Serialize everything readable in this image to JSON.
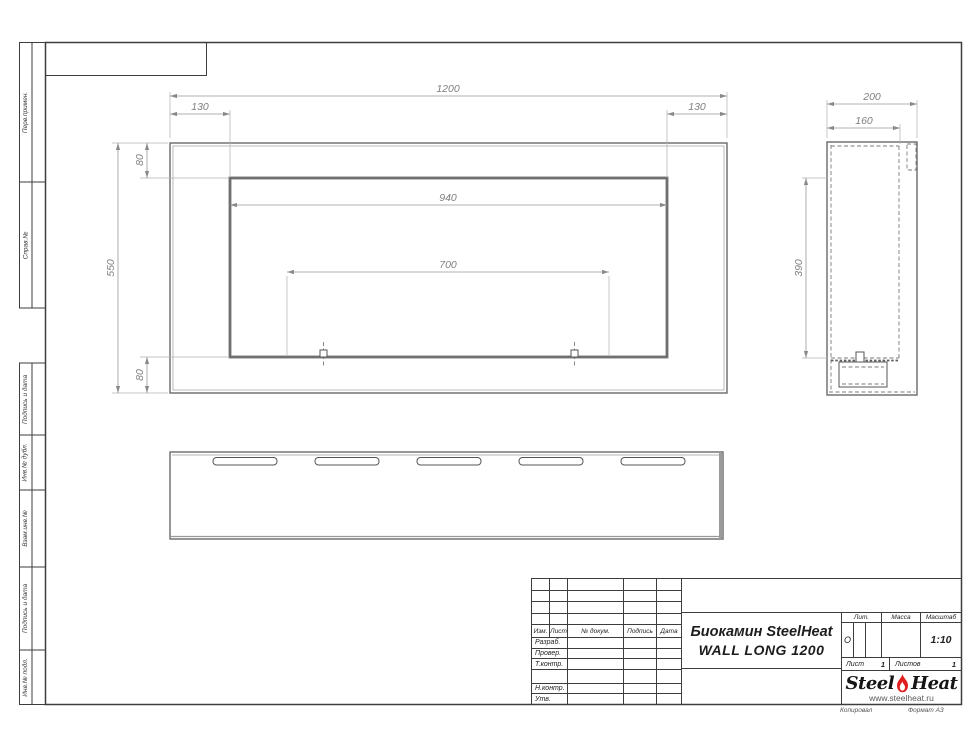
{
  "page": {
    "bg": "#ffffff",
    "frame_color": "#3d3d3d",
    "object_line_color": "#6a6a6a",
    "dim_color": "#7f7f7f",
    "flame_color": "#e01f1f"
  },
  "side_strip": {
    "labels": [
      "Перв.примен.",
      "Справ.№",
      "Подпись и дата",
      "Инв.№ дубл.",
      "Взам.инв.№",
      "Подпись и дата",
      "Инв.№ подл."
    ]
  },
  "front_view": {
    "dim_width": "1200",
    "dim_left_inset": "130",
    "dim_right_inset": "130",
    "dim_opening_width": "940",
    "dim_burner_span": "700",
    "dim_height": "550",
    "dim_top_inset": "80",
    "dim_bottom_inset": "80"
  },
  "side_view": {
    "dim_depth": "200",
    "dim_inner_depth": "160",
    "dim_opening_height": "390"
  },
  "title_block": {
    "header_cols": [
      "Изм.",
      "Лист",
      "№ докум.",
      "Подпись",
      "Дата"
    ],
    "row_labels": [
      "Разраб.",
      "Провер.",
      "Т.контр.",
      "",
      "Н.контр.",
      "Утв."
    ],
    "doc_title_line1": "Биокамин SteelHeat",
    "doc_title_line2": "WALL LONG 1200",
    "lit_label": "Лит.",
    "lit_value": "О",
    "mass_label": "Масса",
    "scale_label": "Масштаб",
    "scale_value": "1:10",
    "sheet_label": "Лист",
    "sheet_value": "1",
    "sheets_label": "Листов",
    "sheets_value": "1",
    "logo": {
      "word1": "Steel",
      "word2": "Heat",
      "url": "www.steelheat.ru"
    }
  },
  "footer": {
    "copied": "Копировал",
    "format": "Формат А3"
  }
}
